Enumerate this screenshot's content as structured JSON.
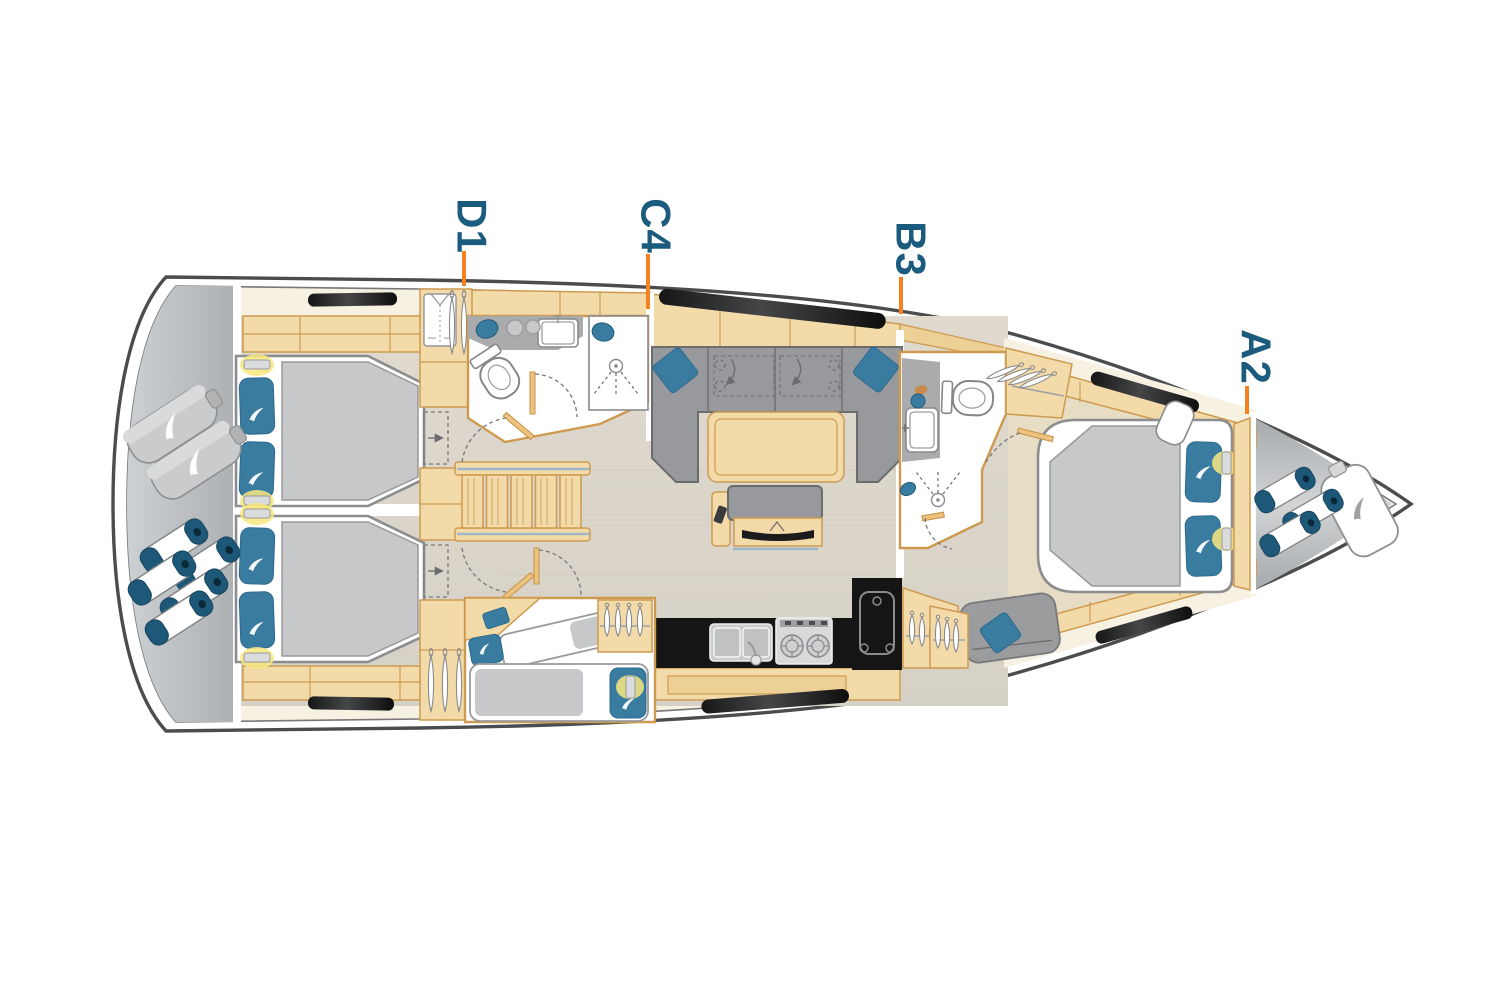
{
  "diagram": {
    "type": "yacht-interior-deck-plan",
    "cabin_labels": [
      {
        "id": "d1",
        "text": "D1"
      },
      {
        "id": "c4",
        "text": "C4"
      },
      {
        "id": "b3",
        "text": "B3"
      },
      {
        "id": "a2",
        "text": "A2"
      }
    ],
    "colors": {
      "label_blue": "#1B5B7E",
      "tick_orange": "#F58220",
      "hull_line": "#4B4C4E",
      "hull_inner_line": "#77787A",
      "cream": "#F7F1E2",
      "floor_fwd": "#E7DCC4",
      "wood": "#F2DAA9",
      "wood_dark": "#EDD096",
      "wood_line": "#CE9A50",
      "upholstery": "#97999C",
      "upholstery_line": "#6B6C6E",
      "duvet": "#C7C8CA",
      "pillow_blue": "#3A7CA0",
      "fender_navy": "#1E5878",
      "fixture_black": "#151515",
      "steel": "#9FB7C9",
      "glow": "#F8E87F"
    }
  }
}
